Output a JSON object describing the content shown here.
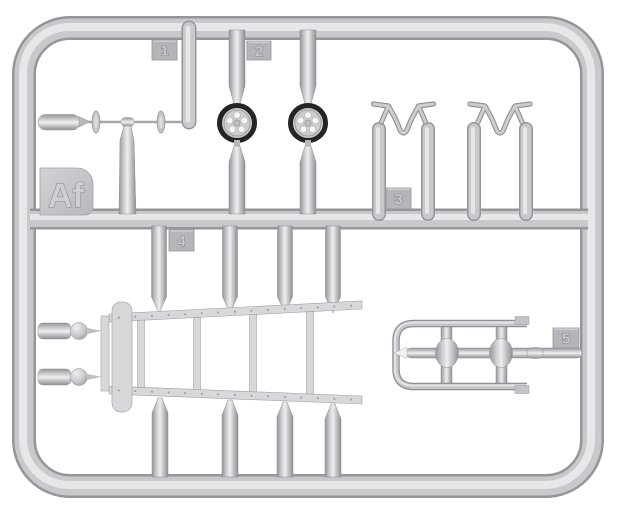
{
  "sprue": {
    "code_label": "Af",
    "part_tags": [
      {
        "label": "1"
      },
      {
        "label": "2"
      },
      {
        "label": "3"
      },
      {
        "label": "4"
      },
      {
        "label": "5"
      }
    ],
    "colors": {
      "background": "#ffffff",
      "plastic_base": "#c9c9cd",
      "plastic_highlight": "#eeeef0",
      "plastic_shadow": "#96969a",
      "tag_plate": "#b5b5b9",
      "wheel_tire": "#242424"
    }
  }
}
